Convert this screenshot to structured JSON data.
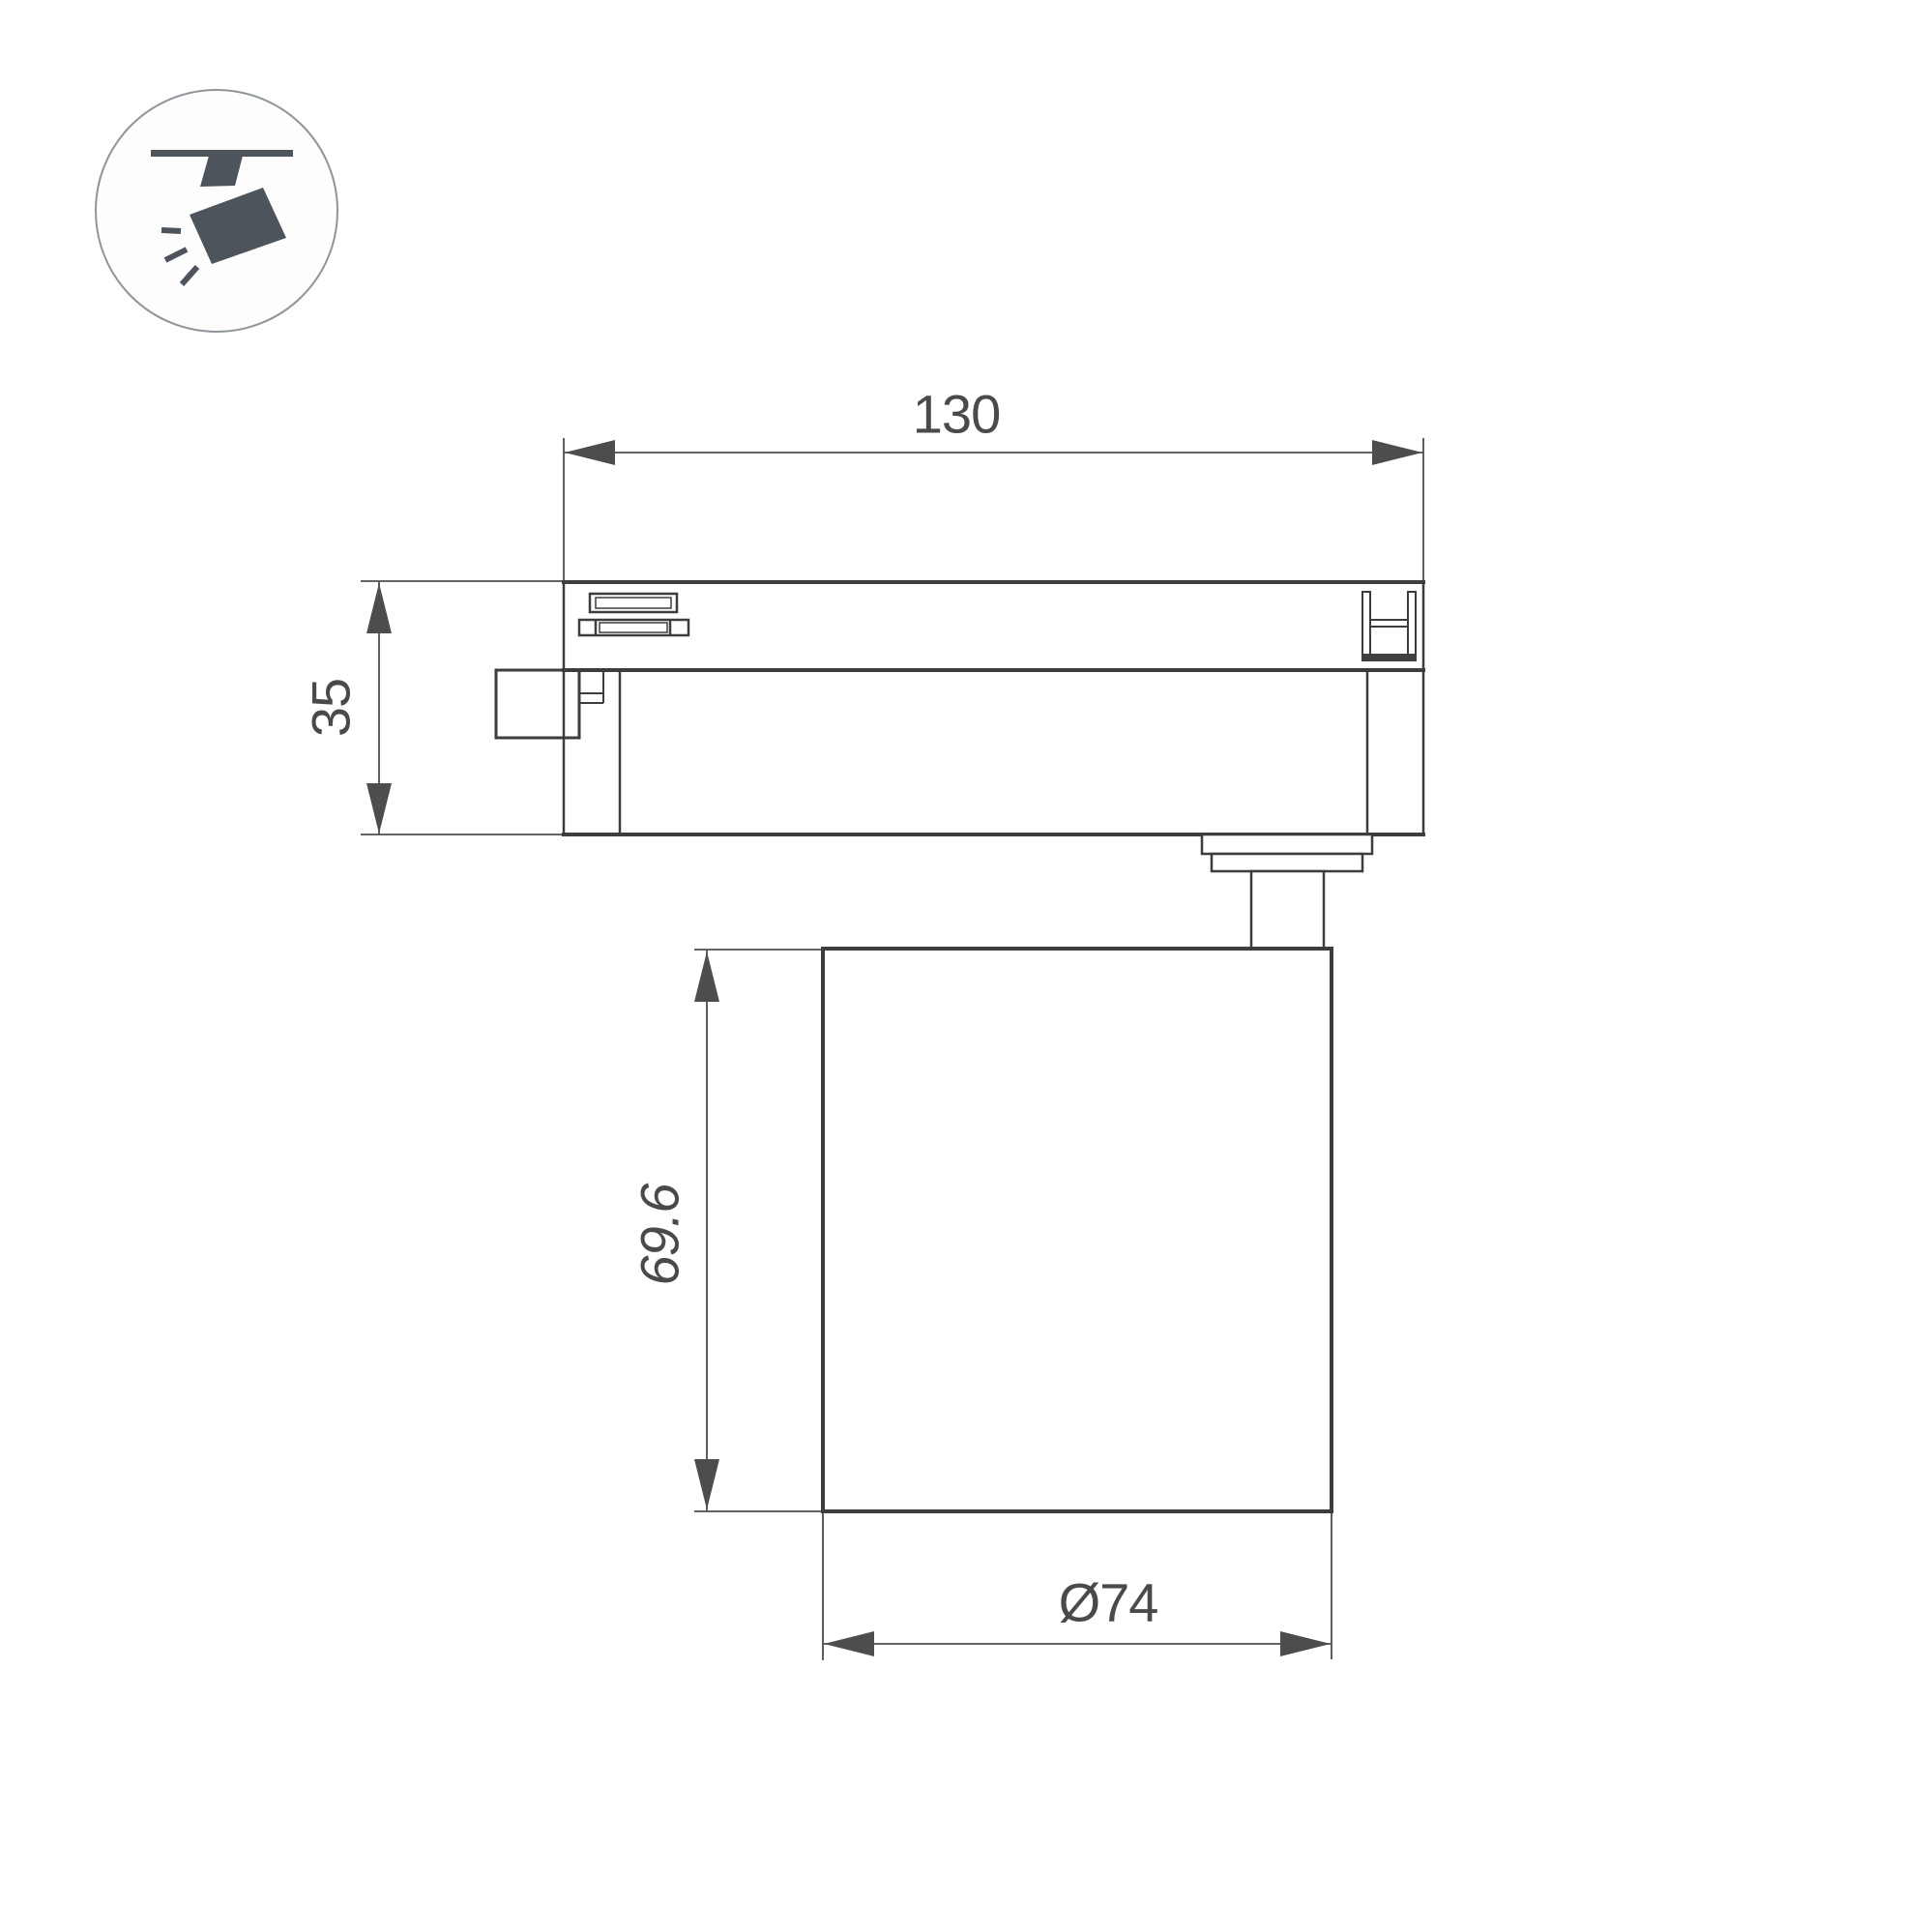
{
  "page": {
    "background_color": "#ffffff",
    "type": "technical dimension drawing of LED track spotlight"
  },
  "icon": {
    "name": "track-spotlight-pictogram",
    "glyph_color": "#4d545c",
    "ring_color": "#8e959b"
  },
  "drawing": {
    "line_color": "#3d3d3d",
    "dimension_color": "#4d4d4d",
    "labels": {
      "adapter_width": "130",
      "adapter_height": "35",
      "body_height": "69.6",
      "body_diameter": "Ø74"
    }
  }
}
